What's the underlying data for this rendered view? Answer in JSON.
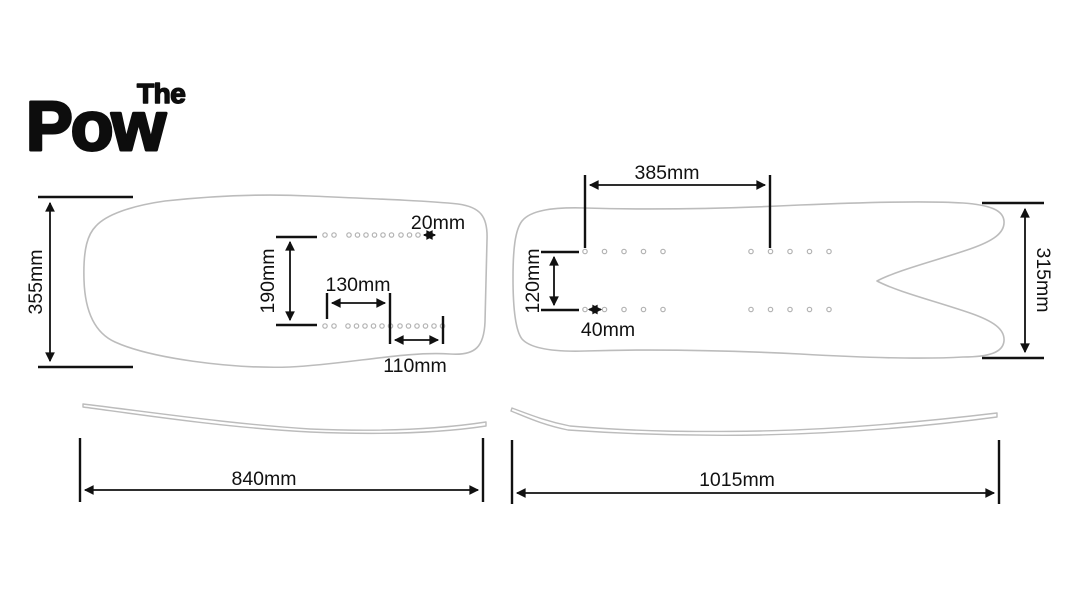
{
  "logo": {
    "top": "The",
    "main": "Pow"
  },
  "colors": {
    "logo": "#0d0d0d",
    "dimension": "#111111",
    "board_outline": "#bcbcbc",
    "insert_hole": "#b3b3b3",
    "background": "#ffffff"
  },
  "left_board": {
    "width_label": "355mm",
    "hole_spacing_label": "20mm",
    "insert_row_gap_label": "190mm",
    "front_insert_span_label": "130mm",
    "rear_insert_span_label": "110mm",
    "length_label": "840mm"
  },
  "right_board": {
    "insert_offset_label": "385mm",
    "insert_row_gap_label": "120mm",
    "hole_spacing_label": "40mm",
    "tail_width_label": "315mm",
    "length_label": "1015mm"
  }
}
